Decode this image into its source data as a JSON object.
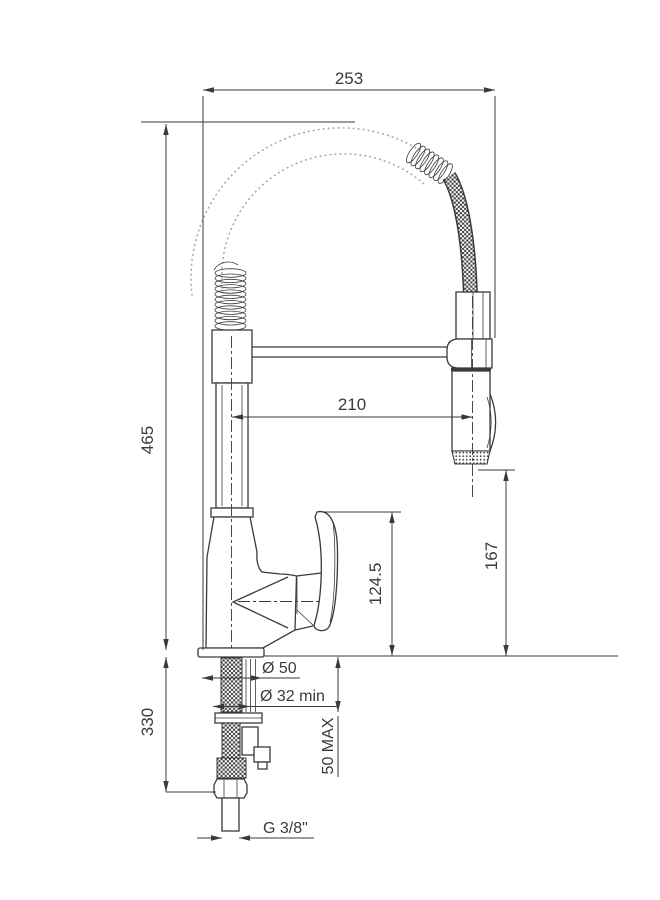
{
  "drawing": {
    "colors": {
      "line": "#3a3a3a",
      "ghost": "#a6a6a6",
      "background": "#ffffff"
    },
    "dimensions": {
      "spout_width": "253",
      "height_above_counter": "465",
      "height_below_counter": "330",
      "spout_reach": "210",
      "spray_head_height": "167",
      "handle_height": "124.5",
      "base_diameter": "Ø 50",
      "mounting_hole_min": "Ø 32 min",
      "counter_thickness_max": "50 MAX",
      "supply_thread": "G 3/8\""
    }
  }
}
